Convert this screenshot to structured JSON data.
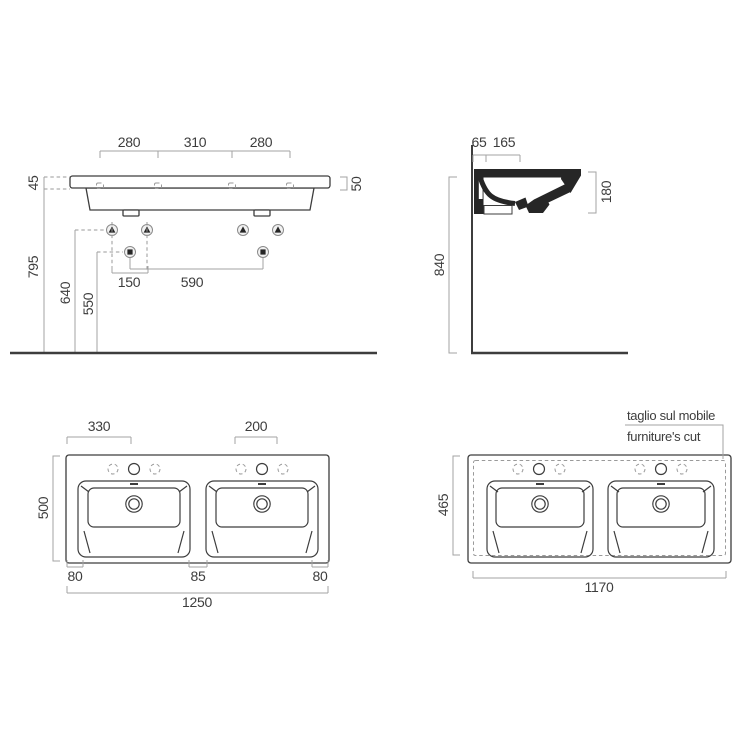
{
  "front_view": {
    "dims": {
      "top_left": "280",
      "top_mid": "310",
      "top_right": "280",
      "thickness": "45",
      "edge": "50",
      "height": "795",
      "mid_height": "640",
      "low_height": "550",
      "fix_spacing": "150",
      "drain_spacing": "590"
    }
  },
  "side_view": {
    "dims": {
      "back_offset": "65",
      "hole_offset": "165",
      "height": "840",
      "depth": "180"
    }
  },
  "plan_view": {
    "dims": {
      "left_hole": "330",
      "right_hole": "200",
      "depth": "500",
      "left_margin": "80",
      "center_gap": "85",
      "right_margin": "80",
      "width": "1250"
    }
  },
  "cut_view": {
    "note": {
      "line1": "taglio sul mobile",
      "line2": "furniture's cut"
    },
    "dims": {
      "depth": "465",
      "width": "1170"
    }
  },
  "colors": {
    "line": "#3d3d3d",
    "dim": "#a3a3a3",
    "text": "#3d3d3d",
    "background": "#ffffff"
  }
}
